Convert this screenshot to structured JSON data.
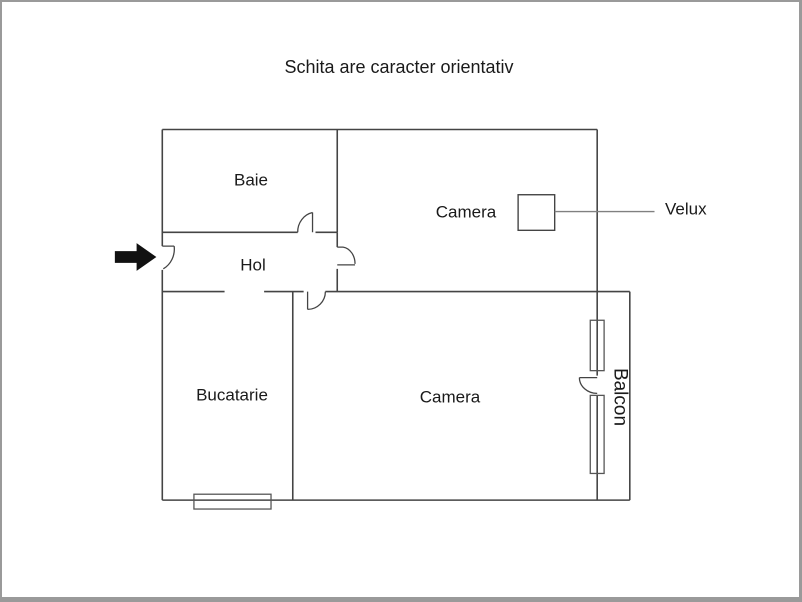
{
  "title": "Schita are caracter orientativ",
  "rooms": {
    "baie": {
      "label": "Baie"
    },
    "camera_top": {
      "label": "Camera"
    },
    "hol": {
      "label": "Hol"
    },
    "bucatarie": {
      "label": "Bucatarie"
    },
    "camera_bottom": {
      "label": "Camera"
    },
    "balcon": {
      "label": "Balcon"
    }
  },
  "annotations": {
    "velux": {
      "label": "Velux"
    }
  },
  "icons": {
    "entrance_arrow": "right-arrow"
  },
  "colors": {
    "background": "#ffffff",
    "border": "#9a9a9a",
    "wall": "#444444",
    "window": "#555555",
    "leader": "#808080",
    "arrow": "#111111",
    "text": "#1a1a1a"
  }
}
